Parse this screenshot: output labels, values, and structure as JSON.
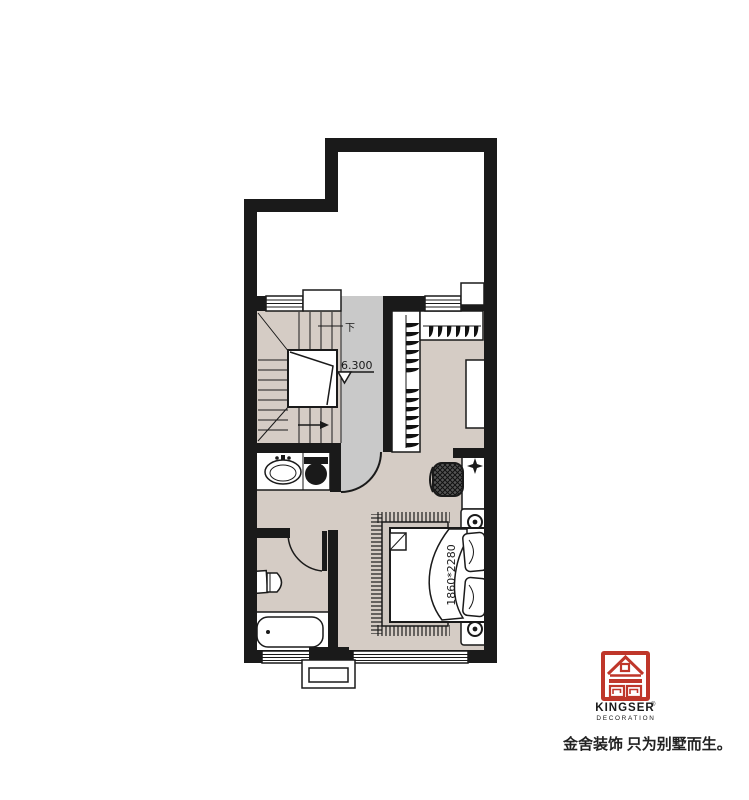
{
  "plan": {
    "stairs": {
      "down_label": "下",
      "elevation": "6.300"
    },
    "bedroom": {
      "bed_size_label": "1860*2280"
    }
  },
  "logo": {
    "brand": "KINGSER",
    "registered": "®",
    "subtitle": "DECORATION",
    "tagline": "金舍装饰 只为别墅而生。"
  },
  "colors": {
    "wall": "#1a1a1a",
    "floor": "#d5ccc5",
    "hall": "#c9c9c9",
    "rug": "#cfc7c0",
    "text": "#1a1a1a",
    "logo_red": "#bf362a"
  }
}
